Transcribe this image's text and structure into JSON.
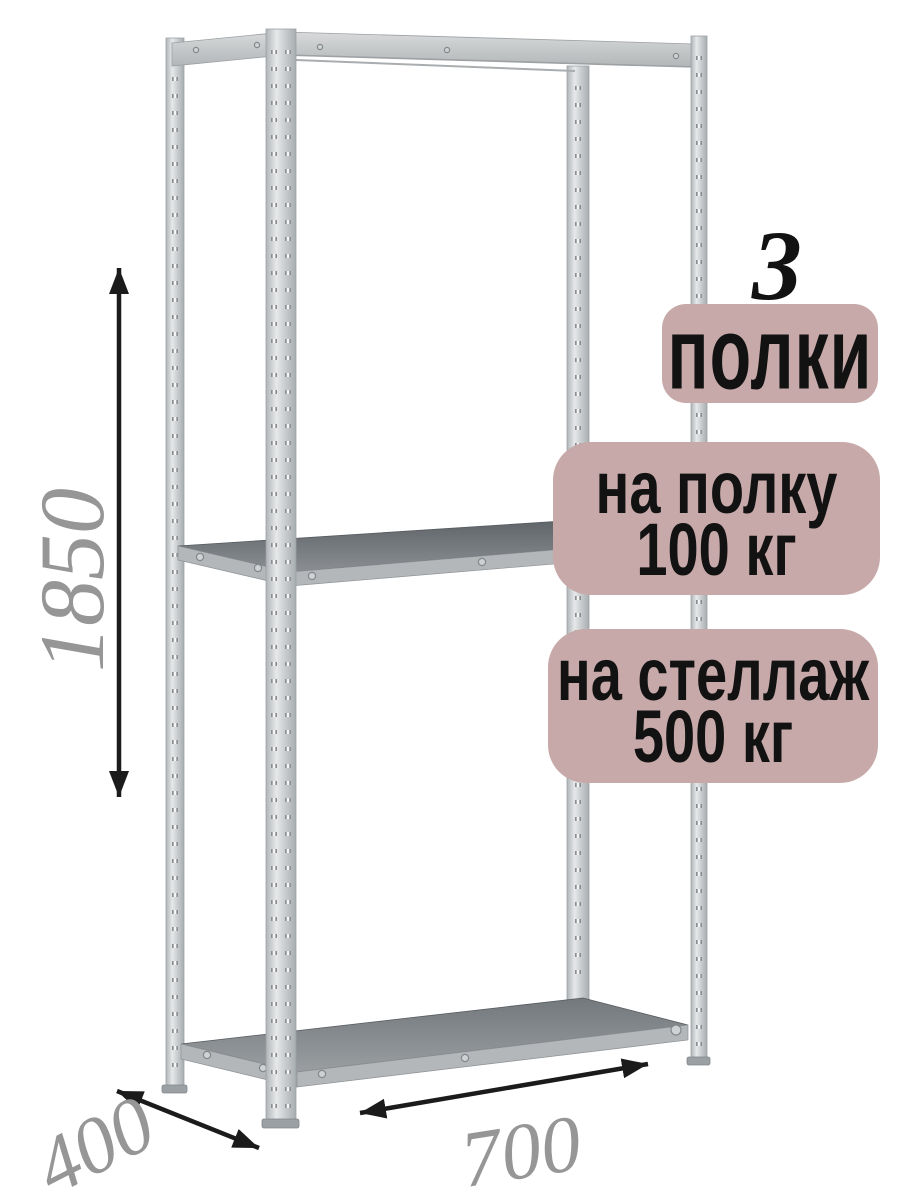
{
  "annotations": {
    "shelf_count_number": "3",
    "shelf_count_label": "полки",
    "per_shelf": {
      "line1": "на полку",
      "line2": "100 кг"
    },
    "per_rack": {
      "line1": "на стеллаж",
      "line2": "500 кг"
    }
  },
  "dimensions": {
    "height": "1850",
    "depth": "400",
    "width": "700"
  },
  "colors": {
    "background": "#ffffff",
    "badge_background": "#c7a9a9",
    "badge_text": "#121212",
    "dimension_text": "#969696",
    "arrow": "#1b1b1b",
    "metal_light": "#e3e5e6",
    "metal_mid": "#c0c4c6",
    "shelf_top_dark": "#61666a"
  }
}
